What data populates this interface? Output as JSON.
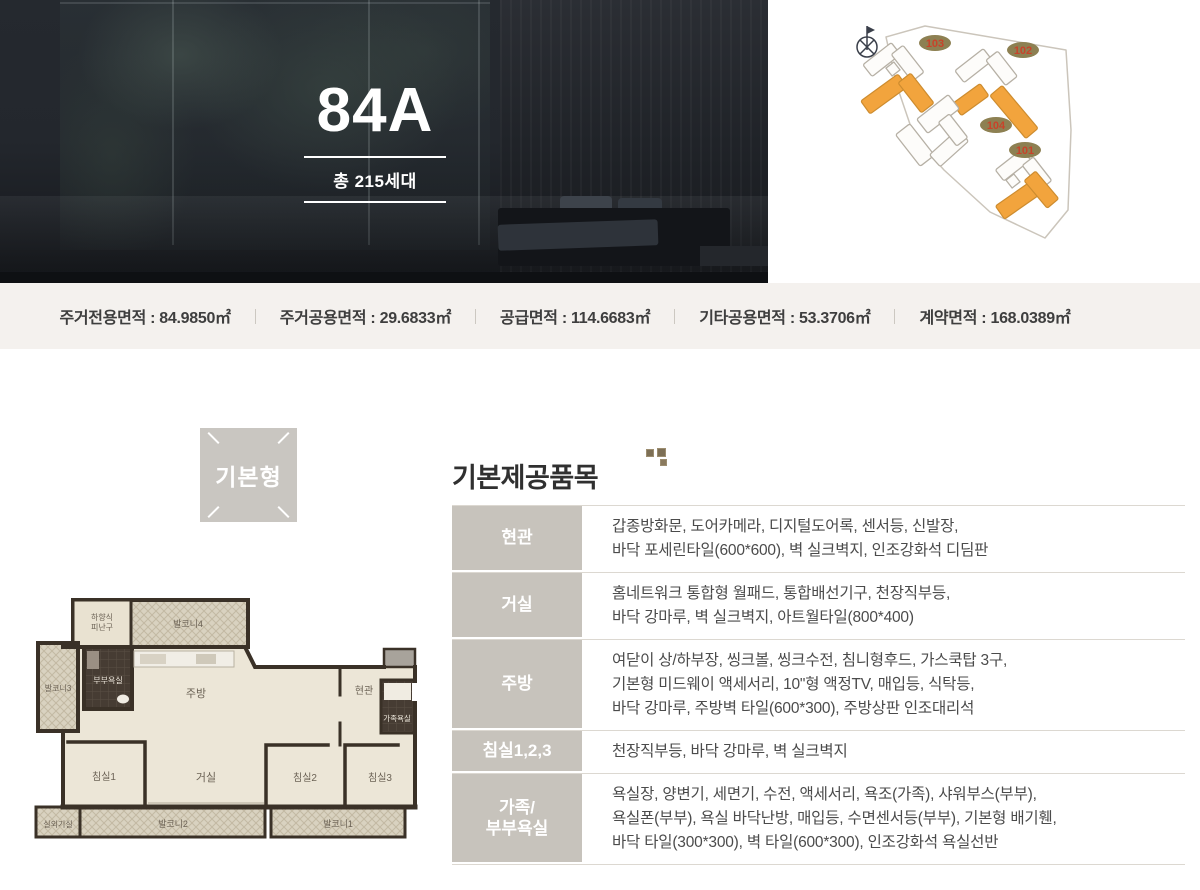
{
  "hero": {
    "unit_type": "84A",
    "total_units": "총 215세대"
  },
  "siteplan": {
    "buildings": [
      "103",
      "102",
      "104",
      "101"
    ],
    "highlight_color": "#f2a43d",
    "badge_color": "#8d8052",
    "badge_text_color": "#c8432a"
  },
  "stats": {
    "items": [
      "주거전용면적 : 84.9850㎡",
      "주거공용면적 : 29.6833㎡",
      "공급면적 : 114.6683㎡",
      "기타공용면적 : 53.3706㎡",
      "계약면적 : 168.0389㎡"
    ]
  },
  "plan": {
    "badge": "기본형",
    "rooms": {
      "evac1": "하향식",
      "evac2": "피난구",
      "balcony4": "발코니4",
      "balcony3": "발코니3",
      "master_bath": "부부욕실",
      "kitchen": "주방",
      "entrance": "현관",
      "family_bath": "가족욕실",
      "bedroom1": "침실1",
      "living": "거실",
      "bedroom2": "침실2",
      "bedroom3": "침실3",
      "ac_room": "실외기실",
      "balcony2": "발코니2",
      "balcony1": "발코니1"
    }
  },
  "items": {
    "title": "기본제공품목",
    "rows": [
      {
        "label": "현관",
        "lines": [
          "갑종방화문, 도어카메라, 디지털도어록, 센서등, 신발장,",
          "바닥 포세린타일(600*600), 벽 실크벽지, 인조강화석 디딤판"
        ]
      },
      {
        "label": "거실",
        "lines": [
          "홈네트워크 통합형 월패드, 통합배선기구, 천장직부등,",
          "바닥 강마루, 벽 실크벽지, 아트월타일(800*400)"
        ]
      },
      {
        "label": "주방",
        "lines": [
          "여닫이 상/하부장, 씽크볼, 씽크수전, 침니형후드, 가스쿡탑 3구,",
          "기본형 미드웨이 액세서리, 10\"형 액정TV, 매입등, 식탁등,",
          "바닥 강마루, 주방벽 타일(600*300), 주방상판 인조대리석"
        ]
      },
      {
        "label": "침실1,2,3",
        "lines": [
          "천장직부등, 바닥 강마루, 벽 실크벽지"
        ]
      },
      {
        "label": [
          "가족/",
          "부부욕실"
        ],
        "lines": [
          "욕실장, 양변기, 세면기, 수전, 액세서리, 욕조(가족), 샤워부스(부부),",
          "욕실폰(부부), 욕실 바닥난방, 매입등, 수면센서등(부부), 기본형 배기휀,",
          "바닥 타일(300*300), 벽 타일(600*300), 인조강화석 욕실선반"
        ]
      }
    ]
  }
}
